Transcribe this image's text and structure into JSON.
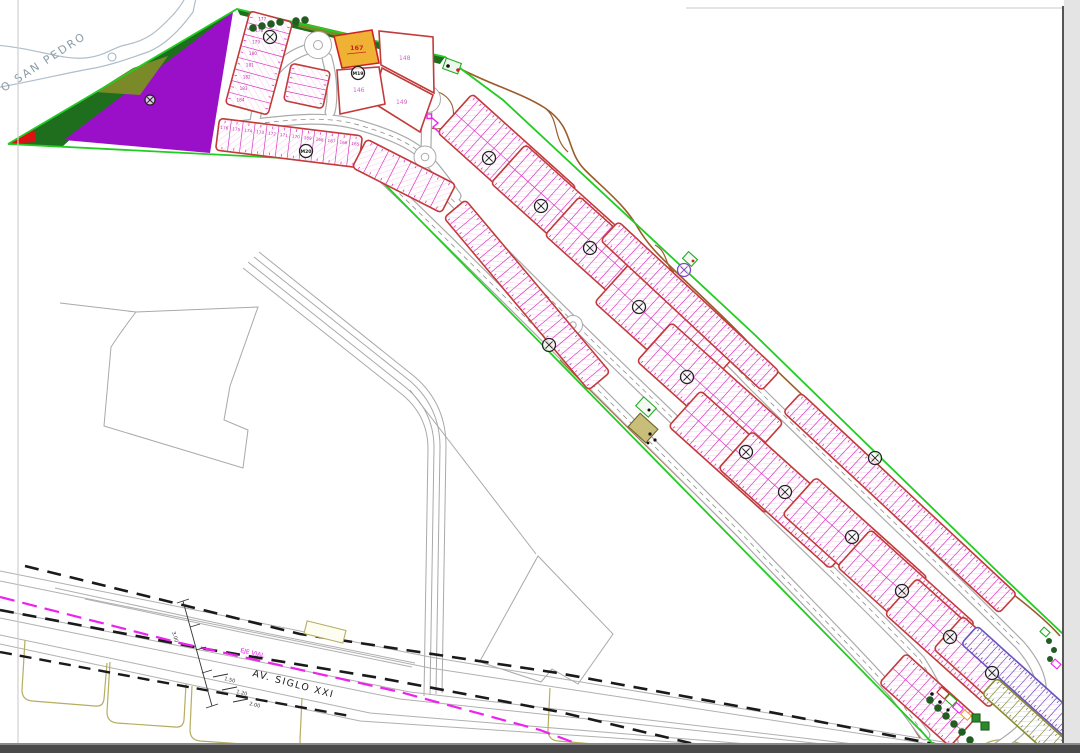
{
  "labels": {
    "river": "O SAN PEDRO",
    "avenue": "AV. SIGLO XXI",
    "axis_label": "EJE VIAL"
  },
  "colors": {
    "boundary_green": "#22cc22",
    "dark_green": "#1e6e1e",
    "olive": "#7a8a28",
    "purple": "#9a10c8",
    "red": "#dd1111",
    "orange_parcel": "#f0b235",
    "block_border": "#c23a3a",
    "lot_line": "#d93ac0",
    "lot_hatch": "#f2a6e2",
    "violet": "#6a52c0",
    "olive_lots": "#8a8a30",
    "brown_track": "#9a5c2a",
    "khaki": "#b5ad60",
    "magenta_axis": "#ee22ee",
    "road_gray": "#b0b0b0",
    "black_dash": "#1a1a1a",
    "river_gray": "#aebecb"
  },
  "parcels": [
    {
      "id": "167",
      "type": "orange"
    },
    {
      "id": "148",
      "type": "white"
    },
    {
      "id": "146",
      "type": "white"
    },
    {
      "id": "149",
      "type": "white"
    }
  ],
  "map": {
    "row_lot_numbers": [
      "176",
      "175",
      "174",
      "173",
      "172",
      "171",
      "170",
      "169",
      "168",
      "167",
      "166",
      "165"
    ],
    "row_a_numbers": [
      "184",
      "183",
      "182",
      "181",
      "180",
      "179",
      "178",
      "177"
    ],
    "dims": [
      {
        "t": "3.00",
        "x": 172,
        "y": 632,
        "r": 74
      },
      {
        "t": "1.50",
        "x": 224,
        "y": 680,
        "r": 14
      },
      {
        "t": "1.20",
        "x": 236,
        "y": 693,
        "r": 14
      },
      {
        "t": "2.00",
        "x": 249,
        "y": 705,
        "r": 14
      }
    ],
    "markers": [
      {
        "x": 270,
        "y": 37,
        "label": ""
      },
      {
        "x": 358,
        "y": 73,
        "label": "M19"
      },
      {
        "x": 306,
        "y": 151,
        "label": "M20"
      },
      {
        "x": 150,
        "y": 100,
        "label": "",
        "small": true
      },
      {
        "x": 489,
        "y": 158,
        "label": ""
      },
      {
        "x": 541,
        "y": 206,
        "label": ""
      },
      {
        "x": 590,
        "y": 248,
        "label": ""
      },
      {
        "x": 639,
        "y": 307,
        "label": ""
      },
      {
        "x": 687,
        "y": 377,
        "label": ""
      },
      {
        "x": 746,
        "y": 452,
        "label": ""
      },
      {
        "x": 785,
        "y": 492,
        "label": ""
      },
      {
        "x": 852,
        "y": 537,
        "label": ""
      },
      {
        "x": 902,
        "y": 591,
        "label": ""
      },
      {
        "x": 950,
        "y": 637,
        "label": ""
      },
      {
        "x": 992,
        "y": 673,
        "label": ""
      },
      {
        "x": 549,
        "y": 345,
        "label": ""
      },
      {
        "x": 684,
        "y": 270,
        "label": "",
        "violet": true
      },
      {
        "x": 875,
        "y": 458,
        "label": ""
      }
    ],
    "blocks": [
      {
        "name": "block-row-a",
        "cx": 259,
        "cy": 63,
        "l": 96,
        "w": 44,
        "rot": -75,
        "rows": 1,
        "lotw": 12,
        "numbers": "row_a_numbers",
        "numRot": 75
      },
      {
        "name": "block-mini-row",
        "cx": 307,
        "cy": 86,
        "l": 38,
        "w": 40,
        "rot": -78,
        "rows": 1,
        "lotw": 10
      },
      {
        "name": "block-row-b1",
        "cx": 289,
        "cy": 143,
        "l": 144,
        "w": 32,
        "rot": 7,
        "rows": 1,
        "lotw": 12,
        "numbers": "row_lot_numbers"
      },
      {
        "name": "block-row-b2",
        "cx": 404,
        "cy": 176,
        "l": 100,
        "w": 32,
        "rot": 27,
        "rows": 1,
        "lotw": 12
      },
      {
        "name": "strip-west",
        "cx": 527,
        "cy": 295,
        "l": 225,
        "w": 28,
        "rot": 50,
        "rows": 1,
        "lotw": 9
      },
      {
        "name": "block-1",
        "cx": 507,
        "cy": 160,
        "l": 140,
        "w": 52,
        "rot": 42,
        "rows": 2,
        "lotw": 9
      },
      {
        "name": "block-2",
        "cx": 564,
        "cy": 214,
        "l": 150,
        "w": 52,
        "rot": 42,
        "rows": 2,
        "lotw": 9
      },
      {
        "name": "block-3",
        "cx": 618,
        "cy": 266,
        "l": 150,
        "w": 52,
        "rot": 42,
        "rows": 2,
        "lotw": 9
      },
      {
        "name": "block-4",
        "cx": 664,
        "cy": 330,
        "l": 140,
        "w": 52,
        "rot": 42,
        "rows": 2,
        "lotw": 9
      },
      {
        "name": "block-5",
        "cx": 710,
        "cy": 392,
        "l": 150,
        "w": 52,
        "rot": 42,
        "rows": 2,
        "lotw": 9
      },
      {
        "name": "block-6",
        "cx": 733,
        "cy": 452,
        "l": 130,
        "w": 48,
        "rot": 42,
        "rows": 2,
        "lotw": 9
      },
      {
        "name": "block-7",
        "cx": 791,
        "cy": 500,
        "l": 150,
        "w": 50,
        "rot": 42,
        "rows": 2,
        "lotw": 9
      },
      {
        "name": "block-8",
        "cx": 855,
        "cy": 546,
        "l": 150,
        "w": 50,
        "rot": 42,
        "rows": 2,
        "lotw": 9
      },
      {
        "name": "block-9",
        "cx": 906,
        "cy": 595,
        "l": 140,
        "w": 50,
        "rot": 42,
        "rows": 2,
        "lotw": 9
      },
      {
        "name": "block-10",
        "cx": 953,
        "cy": 643,
        "l": 140,
        "w": 48,
        "rot": 42,
        "rows": 2,
        "lotw": 9
      },
      {
        "name": "block-11",
        "cx": 928,
        "cy": 700,
        "l": 95,
        "w": 40,
        "rot": 42,
        "rows": 2,
        "lotw": 9
      },
      {
        "name": "block-12",
        "cx": 991,
        "cy": 671,
        "l": 115,
        "w": 44,
        "rot": 42,
        "rows": 2,
        "lotw": 9
      },
      {
        "name": "strip-east-1",
        "cx": 690,
        "cy": 306,
        "l": 220,
        "w": 26,
        "rot": 43,
        "rows": 1,
        "lotw": 8
      },
      {
        "name": "strip-east-2",
        "cx": 900,
        "cy": 503,
        "l": 295,
        "w": 26,
        "rot": 43,
        "rows": 1,
        "lotw": 8
      },
      {
        "name": "strip-violet",
        "cx": 1025,
        "cy": 685,
        "l": 150,
        "w": 24,
        "rot": 42,
        "rows": 1,
        "lotw": 7,
        "cls": "violet"
      },
      {
        "name": "strip-olive",
        "cx": 1036,
        "cy": 728,
        "l": 125,
        "w": 22,
        "rot": 42,
        "rows": 1,
        "lotw": 8,
        "cls": "olive"
      }
    ],
    "trees": [
      {
        "x": 253,
        "y": 28
      },
      {
        "x": 262,
        "y": 26
      },
      {
        "x": 271,
        "y": 24
      },
      {
        "x": 280,
        "y": 22
      },
      {
        "x": 296,
        "y": 21
      },
      {
        "x": 305,
        "y": 20
      },
      {
        "x": 930,
        "y": 700
      },
      {
        "x": 938,
        "y": 708
      },
      {
        "x": 946,
        "y": 716
      },
      {
        "x": 954,
        "y": 724
      },
      {
        "x": 962,
        "y": 732
      },
      {
        "x": 970,
        "y": 740
      },
      {
        "x": 1049,
        "y": 641,
        "r": 3
      },
      {
        "x": 1054,
        "y": 650,
        "r": 3
      },
      {
        "x": 1050,
        "y": 659,
        "r": 3
      },
      {
        "x": 448,
        "y": 64,
        "r": 2.5
      },
      {
        "x": 455,
        "y": 68,
        "r": 2.5
      }
    ],
    "icons": [
      {
        "x": 452,
        "y": 66,
        "w": 16,
        "h": 11,
        "rot": 20,
        "fill": "#eef7ee",
        "stroke": "#22aa22"
      },
      {
        "x": 646,
        "y": 407,
        "w": 17,
        "h": 12,
        "rot": 42,
        "fill": "#f2faf2",
        "stroke": "#22aa22"
      },
      {
        "x": 643,
        "y": 428,
        "w": 24,
        "h": 18,
        "rot": 42,
        "fill": "#c9bd7a",
        "stroke": "#6b6428"
      },
      {
        "x": 690,
        "y": 259,
        "w": 12,
        "h": 9,
        "rot": 42,
        "fill": "#f2faf2",
        "stroke": "#22aa22"
      },
      {
        "x": 943,
        "y": 693,
        "w": 10,
        "h": 7,
        "rot": 42,
        "fill": "#ffffff",
        "stroke": "#cc2222"
      },
      {
        "x": 951,
        "y": 700,
        "w": 10,
        "h": 7,
        "rot": 42,
        "fill": "#ffffff",
        "stroke": "#22aa22"
      },
      {
        "x": 958,
        "y": 708,
        "w": 9,
        "h": 6,
        "rot": 42,
        "fill": "#ffffff",
        "stroke": "#ee22ee"
      },
      {
        "x": 966,
        "y": 715,
        "w": 9,
        "h": 6,
        "rot": 42,
        "fill": "#ffffff",
        "stroke": "#e8a030"
      },
      {
        "x": 976,
        "y": 718,
        "w": 8,
        "h": 8,
        "rot": 0,
        "fill": "#2a8a2a",
        "stroke": "#1e5c1e"
      },
      {
        "x": 985,
        "y": 726,
        "w": 8,
        "h": 8,
        "rot": 0,
        "fill": "#2a8a2a",
        "stroke": "#1e5c1e"
      },
      {
        "x": 1056,
        "y": 664,
        "w": 8,
        "h": 6,
        "rot": 42,
        "fill": "#ffffff",
        "stroke": "#ee22ee"
      },
      {
        "x": 1045,
        "y": 632,
        "w": 8,
        "h": 6,
        "rot": 42,
        "fill": "#ffffff",
        "stroke": "#22aa22"
      },
      {
        "x": 325,
        "y": 632,
        "w": 40,
        "h": 13,
        "rot": 14,
        "fill": "#fdfdf2",
        "stroke": "#b5ad60"
      }
    ],
    "dots": [
      {
        "x": 448,
        "y": 66,
        "r": 1.8,
        "fill": "#111111"
      },
      {
        "x": 458,
        "y": 70,
        "r": 1.8,
        "fill": "#cc2222"
      },
      {
        "x": 650,
        "y": 434,
        "r": 1.6,
        "fill": "#111111"
      },
      {
        "x": 655,
        "y": 440,
        "r": 1.6,
        "fill": "#111111"
      },
      {
        "x": 648,
        "y": 443,
        "r": 1.4,
        "fill": "#111111"
      },
      {
        "x": 932,
        "y": 694,
        "r": 1.8,
        "fill": "#111111"
      },
      {
        "x": 940,
        "y": 702,
        "r": 1.8,
        "fill": "#111111"
      },
      {
        "x": 948,
        "y": 710,
        "r": 1.6,
        "fill": "#111111"
      },
      {
        "x": 649,
        "y": 410,
        "r": 1.5,
        "fill": "#111111"
      },
      {
        "x": 693,
        "y": 261,
        "r": 1.4,
        "fill": "#cc2222"
      }
    ]
  }
}
